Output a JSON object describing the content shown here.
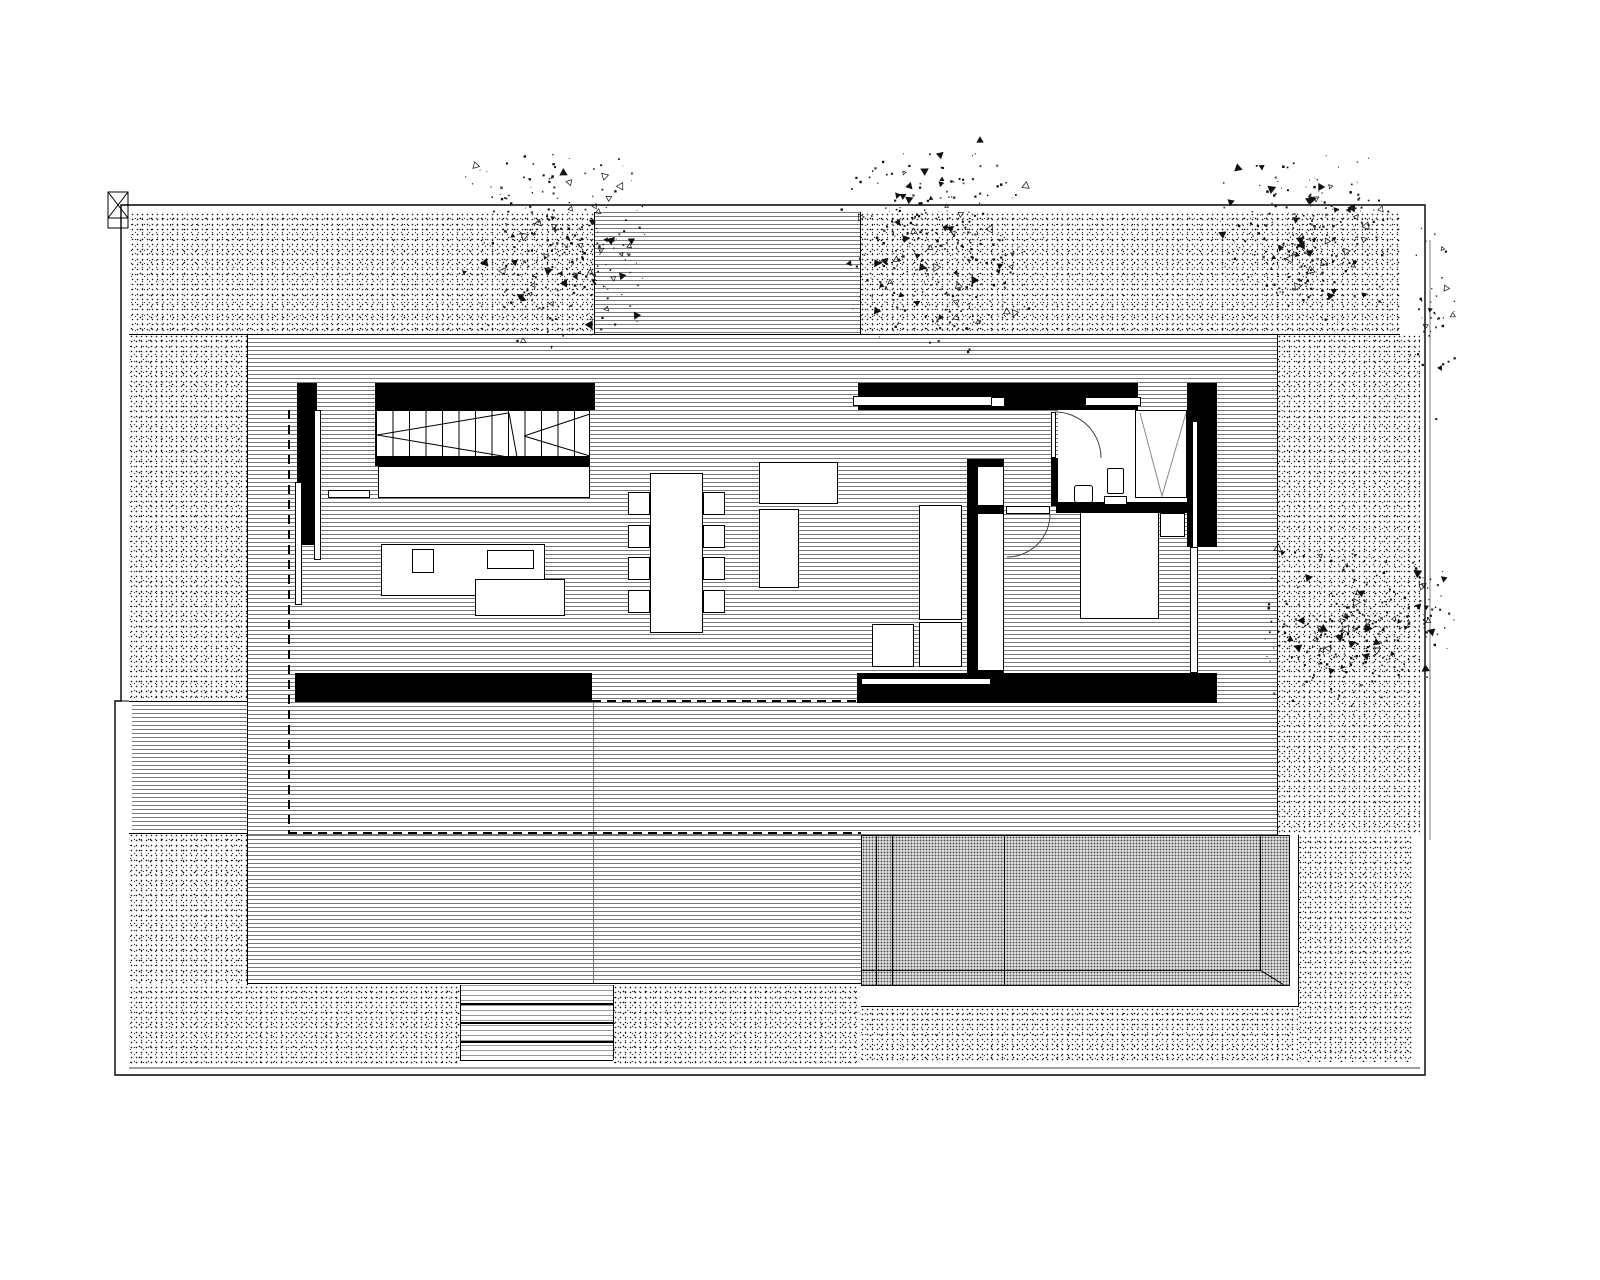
{
  "plan": {
    "type": "architectural-site-floor-plan",
    "colors": {
      "ink": "#000000",
      "line_gray": "#787878",
      "light_gray": "#9a9a9a",
      "paper": "#ffffff"
    },
    "regions": [
      {
        "n": "site-gravel-top-left",
        "k": "stipple",
        "x": 130,
        "y": 212,
        "w": 464,
        "h": 122
      },
      {
        "n": "site-gravel-top-right",
        "k": "stipple",
        "x": 860,
        "y": 212,
        "w": 540,
        "h": 122
      },
      {
        "n": "site-gravel-left",
        "k": "stipple",
        "x": 129,
        "y": 334,
        "w": 118,
        "h": 367
      },
      {
        "n": "site-gravel-left-lower",
        "k": "stipple",
        "x": 129,
        "y": 833,
        "w": 119,
        "h": 152
      },
      {
        "n": "site-gravel-right",
        "k": "stipple",
        "x": 1277,
        "y": 334,
        "w": 143,
        "h": 501
      },
      {
        "n": "site-gravel-right-lower",
        "k": "stipple",
        "x": 1298,
        "y": 835,
        "w": 115,
        "h": 227
      },
      {
        "n": "site-gravel-bottom-left",
        "k": "stipple",
        "x": 129,
        "y": 985,
        "w": 331,
        "h": 80
      },
      {
        "n": "site-gravel-bottom-mid",
        "k": "stipple",
        "x": 613,
        "y": 985,
        "w": 247,
        "h": 80
      },
      {
        "n": "site-gravel-bottom-right",
        "k": "stipple",
        "x": 860,
        "y": 1007,
        "w": 438,
        "h": 55
      },
      {
        "n": "deck-terrace-main",
        "k": "deck",
        "x": 247,
        "y": 334,
        "w": 1030,
        "h": 501
      },
      {
        "n": "deck-terrace-lower",
        "k": "deck",
        "x": 247,
        "y": 835,
        "w": 614,
        "h": 148
      },
      {
        "n": "deck-entry-path",
        "k": "deck",
        "x": 594,
        "y": 212,
        "w": 266,
        "h": 122
      },
      {
        "n": "deck-left-strip",
        "k": "deck",
        "x": 132,
        "y": 701,
        "w": 115,
        "h": 132
      },
      {
        "n": "deck-top-edge",
        "k": "line",
        "x": 129,
        "y": 334,
        "w": 1271,
        "h": 1
      },
      {
        "n": "deck-left-edge",
        "k": "line",
        "x": 247,
        "y": 334,
        "w": 1,
        "h": 651
      },
      {
        "n": "deck-right-edge",
        "k": "line",
        "x": 1277,
        "y": 334,
        "w": 1,
        "h": 501
      },
      {
        "n": "entry-left-edge",
        "k": "line",
        "x": 594,
        "y": 212,
        "w": 1,
        "h": 122
      },
      {
        "n": "entry-right-edge",
        "k": "line",
        "x": 860,
        "y": 212,
        "w": 1,
        "h": 122
      },
      {
        "n": "left-strip-top-edge",
        "k": "line",
        "x": 129,
        "y": 701,
        "w": 118,
        "h": 1
      },
      {
        "n": "left-strip-bottom-edge",
        "k": "line",
        "x": 129,
        "y": 833,
        "w": 119,
        "h": 1
      },
      {
        "n": "deck-bottom-edge",
        "k": "line",
        "x": 247,
        "y": 983,
        "w": 614,
        "h": 1
      },
      {
        "n": "deck-separator",
        "k": "line",
        "x": 593,
        "y": 703,
        "w": 1,
        "h": 280,
        "c": "#777"
      },
      {
        "n": "pool-water",
        "k": "pool",
        "x": 861,
        "y": 835,
        "w": 429,
        "h": 151
      },
      {
        "n": "pool-deck-right",
        "k": "white",
        "x": 1290,
        "y": 835,
        "w": 8,
        "h": 172
      },
      {
        "n": "pool-deck-bottom",
        "k": "white",
        "x": 861,
        "y": 986,
        "w": 437,
        "h": 21
      },
      {
        "n": "pool-frame-right",
        "k": "line",
        "x": 1298,
        "y": 835,
        "w": 1,
        "h": 172
      },
      {
        "n": "pool-frame-bottom",
        "k": "line",
        "x": 861,
        "y": 1006,
        "w": 438,
        "h": 1
      },
      {
        "n": "pool-lane-line-1",
        "k": "line",
        "x": 876,
        "y": 836,
        "w": 1,
        "h": 149
      },
      {
        "n": "pool-lane-line-2",
        "k": "line",
        "x": 892,
        "y": 836,
        "w": 1,
        "h": 149
      },
      {
        "n": "pool-lane-line-3",
        "k": "line",
        "x": 1004,
        "y": 836,
        "w": 1,
        "h": 149
      },
      {
        "n": "pool-step-line",
        "k": "line",
        "x": 1260,
        "y": 836,
        "w": 1,
        "h": 134
      },
      {
        "n": "pool-bottom-line",
        "k": "line",
        "x": 861,
        "y": 970,
        "w": 400,
        "h": 1
      },
      {
        "n": "wall-left-north",
        "k": "wall",
        "x": 375,
        "y": 383,
        "w": 220,
        "h": 27
      },
      {
        "n": "wall-left-west",
        "k": "wall",
        "x": 297,
        "y": 383,
        "w": 20,
        "h": 162
      },
      {
        "n": "window-left-west",
        "k": "box",
        "x": 295,
        "y": 482,
        "w": 7,
        "h": 123
      },
      {
        "n": "mullion-left-west",
        "k": "box",
        "x": 314,
        "y": 410,
        "w": 7,
        "h": 150
      },
      {
        "n": "stairs",
        "k": "treads",
        "x": 375,
        "y": 410,
        "w": 215,
        "h": 47
      },
      {
        "n": "wall-under-stairs",
        "k": "wall",
        "x": 375,
        "y": 457,
        "w": 215,
        "h": 9
      },
      {
        "n": "stair-landing",
        "k": "box",
        "x": 378,
        "y": 466,
        "w": 212,
        "h": 32
      },
      {
        "n": "wall-shelf",
        "k": "box",
        "x": 328,
        "y": 490,
        "w": 42,
        "h": 8
      },
      {
        "n": "living-sofa",
        "k": "box",
        "x": 381,
        "y": 544,
        "w": 164,
        "h": 52
      },
      {
        "n": "living-side-table",
        "k": "box",
        "x": 412,
        "y": 549,
        "w": 22,
        "h": 24
      },
      {
        "n": "living-coffee-table",
        "k": "box",
        "x": 487,
        "y": 550,
        "w": 47,
        "h": 19
      },
      {
        "n": "living-chaise",
        "k": "box",
        "x": 475,
        "y": 579,
        "w": 90,
        "h": 37
      },
      {
        "n": "wall-left-south",
        "k": "wall",
        "x": 295,
        "y": 673,
        "w": 297,
        "h": 29
      },
      {
        "n": "terrace-sofa-top",
        "k": "box",
        "x": 759,
        "y": 462,
        "w": 79,
        "h": 42
      },
      {
        "n": "terrace-sofa-side",
        "k": "box",
        "x": 759,
        "y": 509,
        "w": 40,
        "h": 79
      },
      {
        "n": "dining-table",
        "k": "box",
        "x": 650,
        "y": 473,
        "w": 53,
        "h": 160
      },
      {
        "n": "dining-chair-1",
        "k": "box",
        "x": 628,
        "y": 492,
        "w": 22,
        "h": 23
      },
      {
        "n": "dining-chair-2",
        "k": "box",
        "x": 628,
        "y": 525,
        "w": 22,
        "h": 23
      },
      {
        "n": "dining-chair-3",
        "k": "box",
        "x": 628,
        "y": 557,
        "w": 22,
        "h": 23
      },
      {
        "n": "dining-chair-4",
        "k": "box",
        "x": 628,
        "y": 590,
        "w": 22,
        "h": 23
      },
      {
        "n": "dining-chair-5",
        "k": "box",
        "x": 703,
        "y": 492,
        "w": 22,
        "h": 23
      },
      {
        "n": "dining-chair-6",
        "k": "box",
        "x": 703,
        "y": 525,
        "w": 22,
        "h": 23
      },
      {
        "n": "dining-chair-7",
        "k": "box",
        "x": 703,
        "y": 557,
        "w": 22,
        "h": 23
      },
      {
        "n": "dining-chair-8",
        "k": "box",
        "x": 703,
        "y": 590,
        "w": 22,
        "h": 23
      },
      {
        "n": "bathroom-floor",
        "k": "white",
        "x": 1058,
        "y": 410,
        "w": 130,
        "h": 92
      },
      {
        "n": "wall-right-north",
        "k": "wall",
        "x": 858,
        "y": 383,
        "w": 280,
        "h": 27
      },
      {
        "n": "window-sill-kitchen",
        "k": "box",
        "x": 853,
        "y": 396,
        "w": 140,
        "h": 10
      },
      {
        "n": "window-sill-square",
        "k": "box",
        "x": 991,
        "y": 397,
        "w": 14,
        "h": 10
      },
      {
        "n": "window-sill-bath",
        "k": "box",
        "x": 1085,
        "y": 397,
        "w": 56,
        "h": 9
      },
      {
        "n": "wardrobe",
        "k": "box",
        "x": 1135,
        "y": 410,
        "w": 52,
        "h": 88
      },
      {
        "n": "wall-right-east",
        "k": "wall",
        "x": 1187,
        "y": 383,
        "w": 30,
        "h": 164
      },
      {
        "n": "window-right-east",
        "k": "box",
        "x": 1192,
        "y": 421,
        "w": 6,
        "h": 130
      },
      {
        "n": "window-bedroom-east",
        "k": "box",
        "x": 1190,
        "y": 547,
        "w": 8,
        "h": 126
      },
      {
        "n": "wall-bath-west",
        "k": "wall",
        "x": 1051,
        "y": 458,
        "w": 7,
        "h": 48
      },
      {
        "n": "bath-door-leaf",
        "k": "box",
        "x": 1051,
        "y": 412,
        "w": 5,
        "h": 46
      },
      {
        "n": "wall-bath-south",
        "k": "wall",
        "x": 1056,
        "y": 502,
        "w": 131,
        "h": 11
      },
      {
        "n": "sink",
        "k": "box",
        "x": 1074,
        "y": 485,
        "w": 19,
        "h": 18,
        "r": 3
      },
      {
        "n": "toilet",
        "k": "box",
        "x": 1107,
        "y": 468,
        "w": 17,
        "h": 26,
        "r": 2
      },
      {
        "n": "toilet-tank",
        "k": "box",
        "x": 1104,
        "y": 496,
        "w": 23,
        "h": 9
      },
      {
        "n": "wall-kitchen-cap-top",
        "k": "wall",
        "x": 967,
        "y": 459,
        "w": 37,
        "h": 8
      },
      {
        "n": "wall-kitchen-spine",
        "k": "wall",
        "x": 967,
        "y": 459,
        "w": 10,
        "h": 218
      },
      {
        "n": "kitchen-cabinet-upper",
        "k": "box",
        "x": 977,
        "y": 466,
        "w": 27,
        "h": 40
      },
      {
        "n": "wall-kitchen-mid",
        "k": "wall",
        "x": 971,
        "y": 506,
        "w": 33,
        "h": 8
      },
      {
        "n": "kitchen-cabinet-lower",
        "k": "box",
        "x": 977,
        "y": 513,
        "w": 27,
        "h": 158
      },
      {
        "n": "wall-kitchen-cap-bottom",
        "k": "wall",
        "x": 967,
        "y": 670,
        "w": 37,
        "h": 7
      },
      {
        "n": "kitchen-island",
        "k": "box",
        "x": 919,
        "y": 505,
        "w": 43,
        "h": 115
      },
      {
        "n": "kitchen-table-a",
        "k": "box",
        "x": 872,
        "y": 624,
        "w": 42,
        "h": 43
      },
      {
        "n": "kitchen-table-b",
        "k": "box",
        "x": 919,
        "y": 622,
        "w": 43,
        "h": 45
      },
      {
        "n": "bed",
        "k": "box",
        "x": 1080,
        "y": 512,
        "w": 79,
        "h": 107
      },
      {
        "n": "bedside-table",
        "k": "box",
        "x": 1160,
        "y": 513,
        "w": 25,
        "h": 24
      },
      {
        "n": "bedroom-door-leaf",
        "k": "box",
        "x": 1006,
        "y": 506,
        "w": 44,
        "h": 8
      },
      {
        "n": "wall-right-south",
        "k": "wall",
        "x": 857,
        "y": 673,
        "w": 360,
        "h": 30
      },
      {
        "n": "window-right-south",
        "k": "box",
        "x": 861,
        "y": 678,
        "w": 130,
        "h": 7
      },
      {
        "n": "overhang-dash-west",
        "k": "dash-v",
        "x": 288,
        "y": 410,
        "w": 2,
        "h": 423
      },
      {
        "n": "overhang-dash-south",
        "k": "dash-h",
        "x": 288,
        "y": 832,
        "w": 573,
        "h": 2
      },
      {
        "n": "glazing-dash-mid",
        "k": "dash-h",
        "x": 592,
        "y": 700,
        "w": 266,
        "h": 2
      },
      {
        "n": "entry-steps",
        "k": "steps",
        "x": 460,
        "y": 985,
        "w": 153,
        "h": 75
      },
      {
        "n": "step-edge-1",
        "k": "line",
        "x": 460,
        "y": 1003,
        "w": 153,
        "h": 2
      },
      {
        "n": "step-edge-2",
        "k": "line",
        "x": 460,
        "y": 1022,
        "w": 153,
        "h": 2
      },
      {
        "n": "step-edge-3",
        "k": "line",
        "x": 460,
        "y": 1041,
        "w": 153,
        "h": 2
      },
      {
        "n": "steps-left-edge",
        "k": "line",
        "x": 460,
        "y": 985,
        "w": 1,
        "h": 75
      },
      {
        "n": "steps-right-edge",
        "k": "line",
        "x": 613,
        "y": 985,
        "w": 1,
        "h": 75
      },
      {
        "n": "steps-bottom-edge",
        "k": "line",
        "x": 460,
        "y": 1060,
        "w": 153,
        "h": 1
      }
    ],
    "paths": [
      {
        "n": "property-boundary",
        "d": "M121,205 L1425,205 L1425,1075 L115,1075 L115,701 L121,701 Z",
        "s": "#000",
        "w": 1.4
      },
      {
        "n": "boundary-connector",
        "d": "M115,701 L129,701",
        "s": "#000",
        "w": 1
      },
      {
        "n": "boundary-inner-bottom",
        "d": "M129,1068 L1420,1068",
        "s": "#000",
        "w": 0.8
      },
      {
        "n": "boundary-east-outer",
        "d": "M1430,240 L1430,840",
        "s": "#555",
        "w": 0.8
      },
      {
        "n": "corner-post-marker",
        "d": "M108,192 h20 v36 h-20 Z M108,192 L128,218 M128,192 L108,218 M108,218 h20",
        "s": "#000",
        "w": 1
      },
      {
        "n": "stair-direction-arrows",
        "d": "M377,435 L508,413 M377,435 L508,457 M509,413 L517,457 M524,436 L590,414 M524,436 L590,456",
        "s": "#000",
        "w": 1
      },
      {
        "n": "wardrobe-hanging-symbol",
        "d": "M1140,413 L1162,496 L1186,413",
        "s": "#888",
        "w": 1
      },
      {
        "n": "bath-door-swing",
        "d": "M1055,412 A46,46 0 0 1 1101,458",
        "s": "#444",
        "w": 1
      },
      {
        "n": "bedroom-door-swing",
        "d": "M1050,514 A43,43 0 0 1 1007,557",
        "s": "#444",
        "w": 1
      },
      {
        "n": "pool-corner-diagonal",
        "d": "M1260,970 L1284,985",
        "s": "#000",
        "w": 1
      }
    ],
    "trees": [
      {
        "n": "tree-canopy-1",
        "cx": 557,
        "cy": 250,
        "rx": 95,
        "ry": 108,
        "count": 300,
        "seed": 11
      },
      {
        "n": "tree-canopy-2",
        "cx": 933,
        "cy": 248,
        "rx": 100,
        "ry": 108,
        "count": 320,
        "seed": 22
      },
      {
        "n": "tree-canopy-3",
        "cx": 1303,
        "cy": 238,
        "rx": 95,
        "ry": 92,
        "count": 260,
        "seed": 33
      },
      {
        "n": "tree-canopy-4",
        "cx": 1348,
        "cy": 626,
        "rx": 92,
        "ry": 88,
        "count": 280,
        "seed": 44
      },
      {
        "n": "tree-scatter-east-1",
        "cx": 1432,
        "cy": 320,
        "rx": 26,
        "ry": 105,
        "count": 40,
        "seed": 55
      },
      {
        "n": "tree-scatter-east-2",
        "cx": 1430,
        "cy": 618,
        "rx": 28,
        "ry": 62,
        "count": 30,
        "seed": 66
      }
    ]
  }
}
